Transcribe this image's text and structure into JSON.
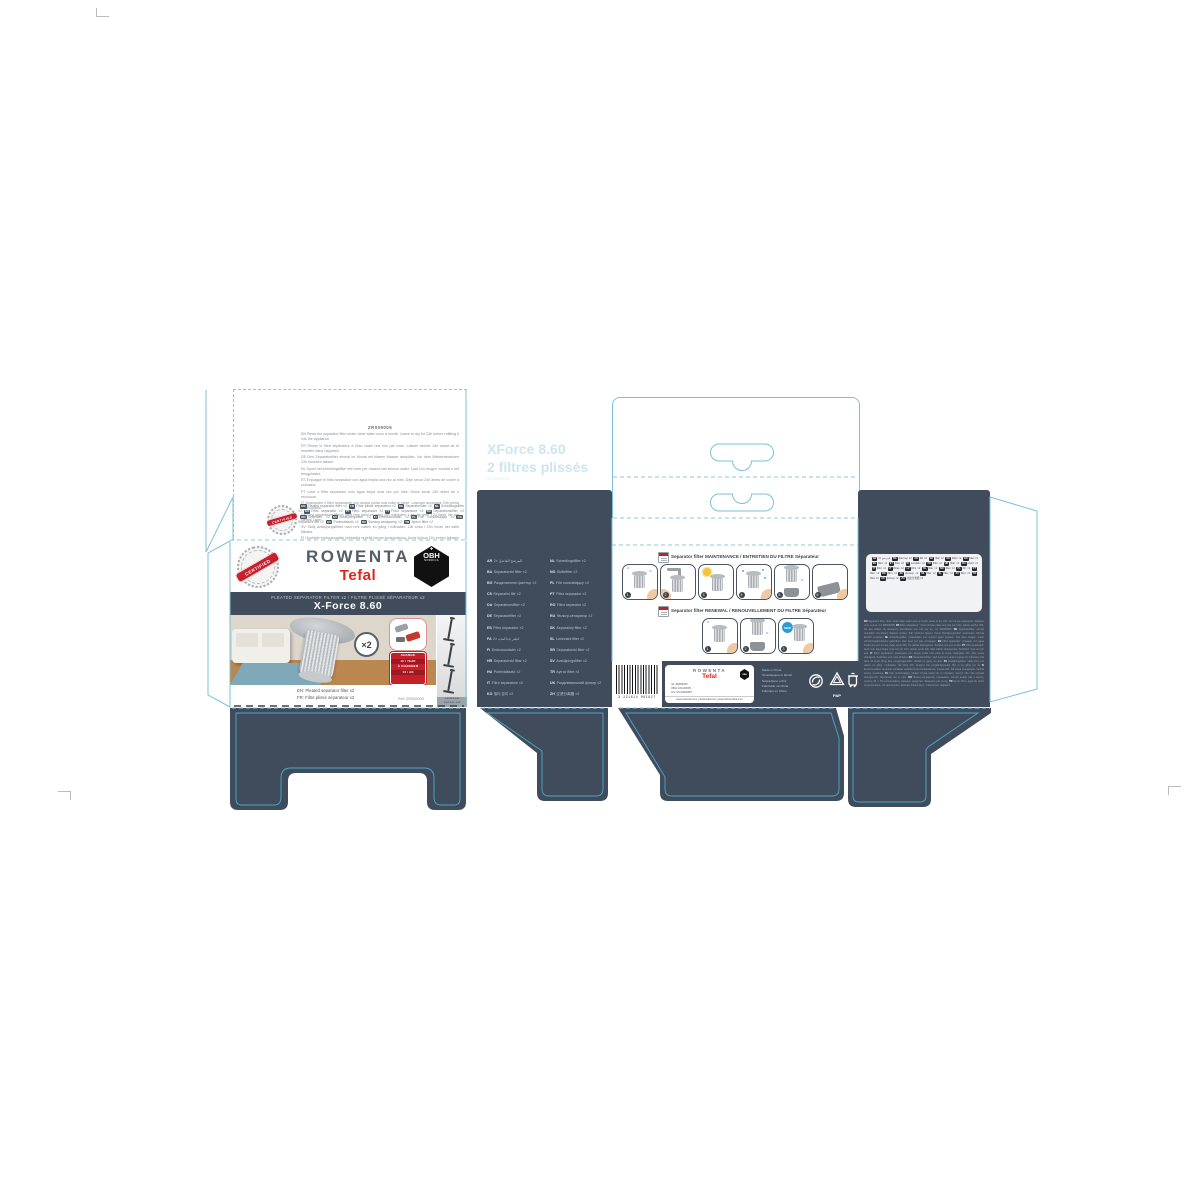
{
  "product": {
    "brand_primary": "ROWENTA",
    "brand_secondary": "Tefal",
    "obh_line1": "OBH",
    "obh_line2": "NORDICA",
    "obh_cross": "✚",
    "certified": "CERTIFIED",
    "title_line": "PLEATED SEPARATOR FILTER x2 / FILTRE PLISSÉ SÉPARATEUR x2",
    "model": "X-Force 8.60",
    "qty_badge": "×2",
    "caption_en": "EN: Pleated separator filter x2",
    "caption_fr": "FR: Filtre plissé séparateur x2",
    "ref": "Ref: ZR009005",
    "change_badge": [
      "CHANGE",
      "1X / YEAR",
      "À CHANGER",
      "1X / AN"
    ],
    "strip_caption_1": "X-FORCE 8.60",
    "strip_caption_2": "FLEX 8.60 / 9.60"
  },
  "plate_marks": {
    "line1": "XForce 8.60",
    "line2": "2 filtres plissés",
    "line3": "ZR 009005 01"
  },
  "back_flap": {
    "heading": "ZR009005",
    "lines": [
      "EN Rinse the separator filter under clear water once a month. Leave to dry for 24h before refitting it into the appliance.",
      "FR Rincer le filtre séparateur à l'eau claire une fois par mois. Laisser sécher 24h avant de le remettre dans l'appareil.",
      "DE Den Separatorfilter einmal im Monat mit klarem Wasser abspülen. Vor dem Wiedereinsetzen 24h trocknen lassen.",
      "NL Spoel het scheidingsfilter één keer per maand met schoon water. Laat 24u drogen voordat u het terugplaatst.",
      "ES Enjuague el filtro separador con agua limpia una vez al mes. Deje secar 24h antes de volver a colocarlo.",
      "PT Lave o filtro separador com água limpa uma vez por mês. Deixe secar 24h antes de o recolocar.",
      "IT Sciacquare il filtro separatore con acqua pulita una volta al mese. Lasciare asciugare 24h prima di rimontarlo.",
      "DA Skyl separationsfilteret med rent vand en gang om måneden. Lad det tørre i 24 timer, før det sættes i igen.",
      "SV Skölj avskiljningsfiltret med rent vatten en gång i månaden. Låt torka i 24h innan det sätts tillbaka.",
      "FI Huuhtele erotussuodatin puhtaalla vedellä kerran kuukaudessa. Anna kuivua 24h ennen takaisin asettamista."
    ]
  },
  "badge_block": {
    "entries": [
      {
        "code": "EN",
        "text": "Pleated separator filter ×2"
      },
      {
        "code": "FR",
        "text": "Filtre plissé séparateur ×2"
      },
      {
        "code": "DE",
        "text": "Separatorfilter ×2"
      },
      {
        "code": "NL",
        "text": "Scheidingsfilter ×2"
      },
      {
        "code": "ES",
        "text": "Filtro separador ×2"
      },
      {
        "code": "PT",
        "text": "Filtro separador ×2"
      },
      {
        "code": "IT",
        "text": "Filtro separatore ×2"
      },
      {
        "code": "DA",
        "text": "Separationsfilter ×2"
      },
      {
        "code": "NO",
        "text": "Skillefilter ×2"
      },
      {
        "code": "SV",
        "text": "Avskiljningsfilter ×2"
      },
      {
        "code": "FI",
        "text": "Erotussuodatin ×2"
      },
      {
        "code": "PL",
        "text": "Filtr rozdzielający ×2"
      },
      {
        "code": "CS",
        "text": "Separační filtr ×2"
      },
      {
        "code": "HU",
        "text": "Porleválasztó ×2"
      },
      {
        "code": "RU",
        "text": "Фильтр-сепаратор ×2"
      },
      {
        "code": "TR",
        "text": "Ayırıcı filtre ×2"
      }
    ]
  },
  "languages": {
    "left": [
      {
        "code": "AR",
        "text": "المرشح الفاصل ×2"
      },
      {
        "code": "BA",
        "text": "Separatorski filter ×2"
      },
      {
        "code": "BG",
        "text": "Разделителен филтър ×2"
      },
      {
        "code": "CS",
        "text": "Separační filtr ×2"
      },
      {
        "code": "DA",
        "text": "Separationsfilter ×2"
      },
      {
        "code": "DE",
        "text": "Separatorfilter ×2"
      },
      {
        "code": "ES",
        "text": "Filtro separador ×2"
      },
      {
        "code": "FA",
        "text": "فیلتر جداکننده ×2"
      },
      {
        "code": "FI",
        "text": "Erotussuodatin ×2"
      },
      {
        "code": "HR",
        "text": "Separatorski filtar ×2"
      },
      {
        "code": "HU",
        "text": "Porleválasztó ×2"
      },
      {
        "code": "IT",
        "text": "Filtro separatore ×2"
      },
      {
        "code": "KO",
        "text": "필터 분리 ×2"
      }
    ],
    "right": [
      {
        "code": "NL",
        "text": "Scheidingsfilter ×2"
      },
      {
        "code": "NO",
        "text": "Skillefilter ×2"
      },
      {
        "code": "PL",
        "text": "Filtr rozdzielający ×2"
      },
      {
        "code": "PT",
        "text": "Filtro separador ×2"
      },
      {
        "code": "RO",
        "text": "Filtru separator ×2"
      },
      {
        "code": "RU",
        "text": "Фильтр-сепаратор ×2"
      },
      {
        "code": "SK",
        "text": "Separačný filter ×2"
      },
      {
        "code": "SL",
        "text": "Ločevalni filter ×2"
      },
      {
        "code": "SR",
        "text": "Separatorski filter ×2"
      },
      {
        "code": "SV",
        "text": "Avskiljningsfilter ×2"
      },
      {
        "code": "TR",
        "text": "Ayırıcı filtre ×2"
      },
      {
        "code": "UK",
        "text": "Розділювальний фільтр ×2"
      },
      {
        "code": "ZH",
        "text": "过滤分离器 ×2"
      }
    ]
  },
  "instructions": {
    "maintenance": {
      "heading": "Separator filter MAINTENANCE / ENTRETIEN DU FILTRE Séparateur",
      "steps": [
        {
          "n": "1"
        },
        {
          "n": "2"
        },
        {
          "n": "3"
        },
        {
          "n": "4"
        },
        {
          "n": "5"
        },
        {
          "n": "6"
        }
      ]
    },
    "renewal": {
      "heading": "Separator filter RENEWAL / RENOUVELLEMENT DU FILTRE Séparateur",
      "steps": [
        {
          "n": "1"
        },
        {
          "n": "2"
        },
        {
          "n": "3"
        }
      ]
    }
  },
  "bottom_strip": {
    "barcode_digits": "3 221614 081927",
    "info_box": {
      "brand1": "ROWENTA",
      "brand2": "Tefal",
      "obh": "OBH",
      "ref_lines": [
        "ref. ZR009005",
        "OBH: 221140005",
        "CN: CS-00940057"
      ],
      "web": "www.rowenta.com | www.tefal.com | www.obhnordica.com"
    },
    "made_in": [
      "Made in China",
      "Произведено в Китай",
      "Napravljeno u Kini",
      "Fabricado na China",
      "Fabriqué en Chine"
    ],
    "pap_label": "PAP"
  },
  "right_panel": {
    "codes_box": [
      {
        "code": "AR",
        "text": "المرشح ×2"
      },
      {
        "code": "BG",
        "text": "филтър ×2"
      },
      {
        "code": "CS",
        "text": "filtr ×2"
      },
      {
        "code": "DA",
        "text": "filter ×2"
      },
      {
        "code": "DE",
        "text": "Filter ×2"
      },
      {
        "code": "EN",
        "text": "filter ×2"
      },
      {
        "code": "ES",
        "text": "filtro ×2"
      },
      {
        "code": "ET",
        "text": "filter ×2"
      },
      {
        "code": "FI",
        "text": "suodatin ×2"
      },
      {
        "code": "FR",
        "text": "filtre ×2"
      },
      {
        "code": "HR",
        "text": "filtar ×2"
      },
      {
        "code": "HU",
        "text": "szűrő ×2"
      },
      {
        "code": "IT",
        "text": "filtro ×2"
      },
      {
        "code": "LT",
        "text": "filtras ×2"
      },
      {
        "code": "LV",
        "text": "filtrs ×2"
      },
      {
        "code": "NL",
        "text": "filter ×2"
      },
      {
        "code": "NO",
        "text": "filter ×2"
      },
      {
        "code": "PL",
        "text": "filtr ×2"
      },
      {
        "code": "PT",
        "text": "filtro ×2"
      },
      {
        "code": "RO",
        "text": "filtru ×2"
      },
      {
        "code": "RU",
        "text": "фильтр ×2"
      },
      {
        "code": "SK",
        "text": "filter ×2"
      },
      {
        "code": "SL",
        "text": "filter ×2"
      },
      {
        "code": "SV",
        "text": "filter ×2"
      },
      {
        "code": "TR",
        "text": "filtre ×2"
      },
      {
        "code": "UK",
        "text": "фільтр ×2"
      },
      {
        "code": "ZH",
        "text": "过滤分离器 ×2"
      }
    ],
    "fineprint": [
      {
        "code": "EN",
        "text": "Separator filter: rinse under clear water once a month, leave to dry 24h. Do not use detergents. Replace once a year, ref. ZR009005."
      },
      {
        "code": "FR",
        "text": "Filtre séparateur : rincer à l'eau claire une fois par mois, laisser sécher 24h. Ne pas utiliser de détergent. Remplacer une fois par an, réf. ZR009005."
      },
      {
        "code": "DE",
        "text": "Separatorfilter: einmal monatlich mit klarem Wasser spülen, 24h trocknen lassen. Keine Reinigungsmittel verwenden. Einmal jährlich ersetzen."
      },
      {
        "code": "NL",
        "text": "Scheidingsfilter: maandelijks met schoon water spoelen, 24u laten drogen. Geen schoonmaakmiddelen gebruiken. Eén keer per jaar vervangen."
      },
      {
        "code": "ES",
        "text": "Filtro separador: enjuagar con agua limpia una vez al mes, dejar secar 24h. No utilizar detergentes. Sustituir una vez al año."
      },
      {
        "code": "PT",
        "text": "Filtro separador: lavar com água limpa uma vez por mês, deixar secar 24h. Não utilizar detergentes. Substituir uma vez por ano."
      },
      {
        "code": "IT",
        "text": "Filtro separatore: sciacquare con acqua pulita una volta al mese, asciugare 24h. Non usare detergenti. Sostituire una volta all'anno."
      },
      {
        "code": "DA",
        "text": "Separationsfilter: skyl med rent vand en gang om måneden, lad tørre 24 timer. Brug ikke rengøringsmidler. Udskift en gang om året."
      },
      {
        "code": "SV",
        "text": "Avskiljningsfilter: skölj med rent vatten en gång i månaden, låt torka 24h. Använd inte rengöringsmedel. Byt ut en gång per år."
      },
      {
        "code": "FI",
        "text": "Erotussuodatin: huuhtele puhtaalla vedellä kerran kuukaudessa, kuivaa 24h. Älä käytä pesuaineita. Vaihda kerran vuodessa."
      },
      {
        "code": "PL",
        "text": "Filtr rozdzielający: płukać czystą wodą raz w miesiącu, suszyć 24h. Nie używać detergentów. Wymieniać raz w roku."
      },
      {
        "code": "RU",
        "text": "Фильтр-сепаратор: промывать чистой водой раз в месяц, сушить 24 ч. Не использовать моющие средства. Заменять раз в год."
      },
      {
        "code": "TR",
        "text": "Ayırıcı filtre: ayda bir temiz suyla durulayın, 24 saat kurutun. Deterjan kullanmayın. Yılda bir kez değiştirin."
      }
    ]
  }
}
